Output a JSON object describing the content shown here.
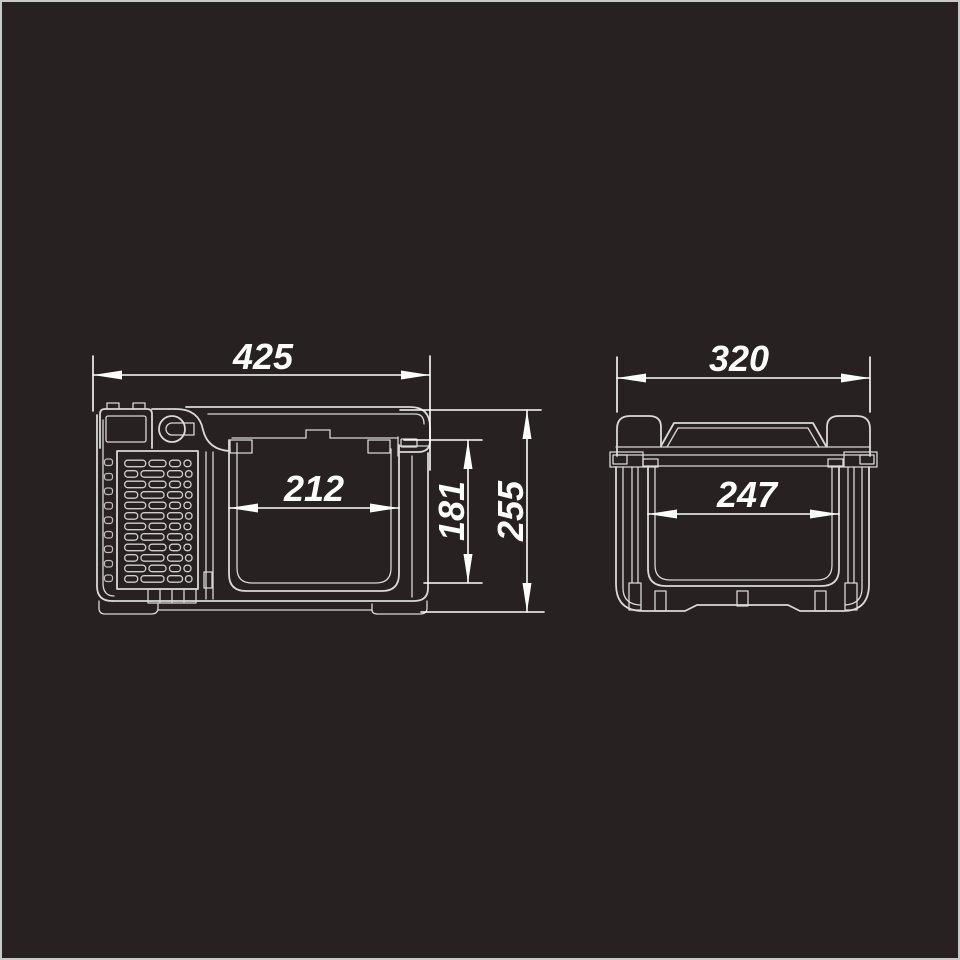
{
  "canvas": {
    "background": "#272221",
    "border_color": "#C9C9C7",
    "line_color": "#D9D9D7",
    "dim_color": "#FDFDFD"
  },
  "front_view": {
    "dims": {
      "overall_width": "425",
      "inner_width": "212",
      "inner_depth": "181",
      "overall_height": "255"
    }
  },
  "side_view": {
    "dims": {
      "overall_width": "320",
      "inner_width": "247"
    }
  }
}
